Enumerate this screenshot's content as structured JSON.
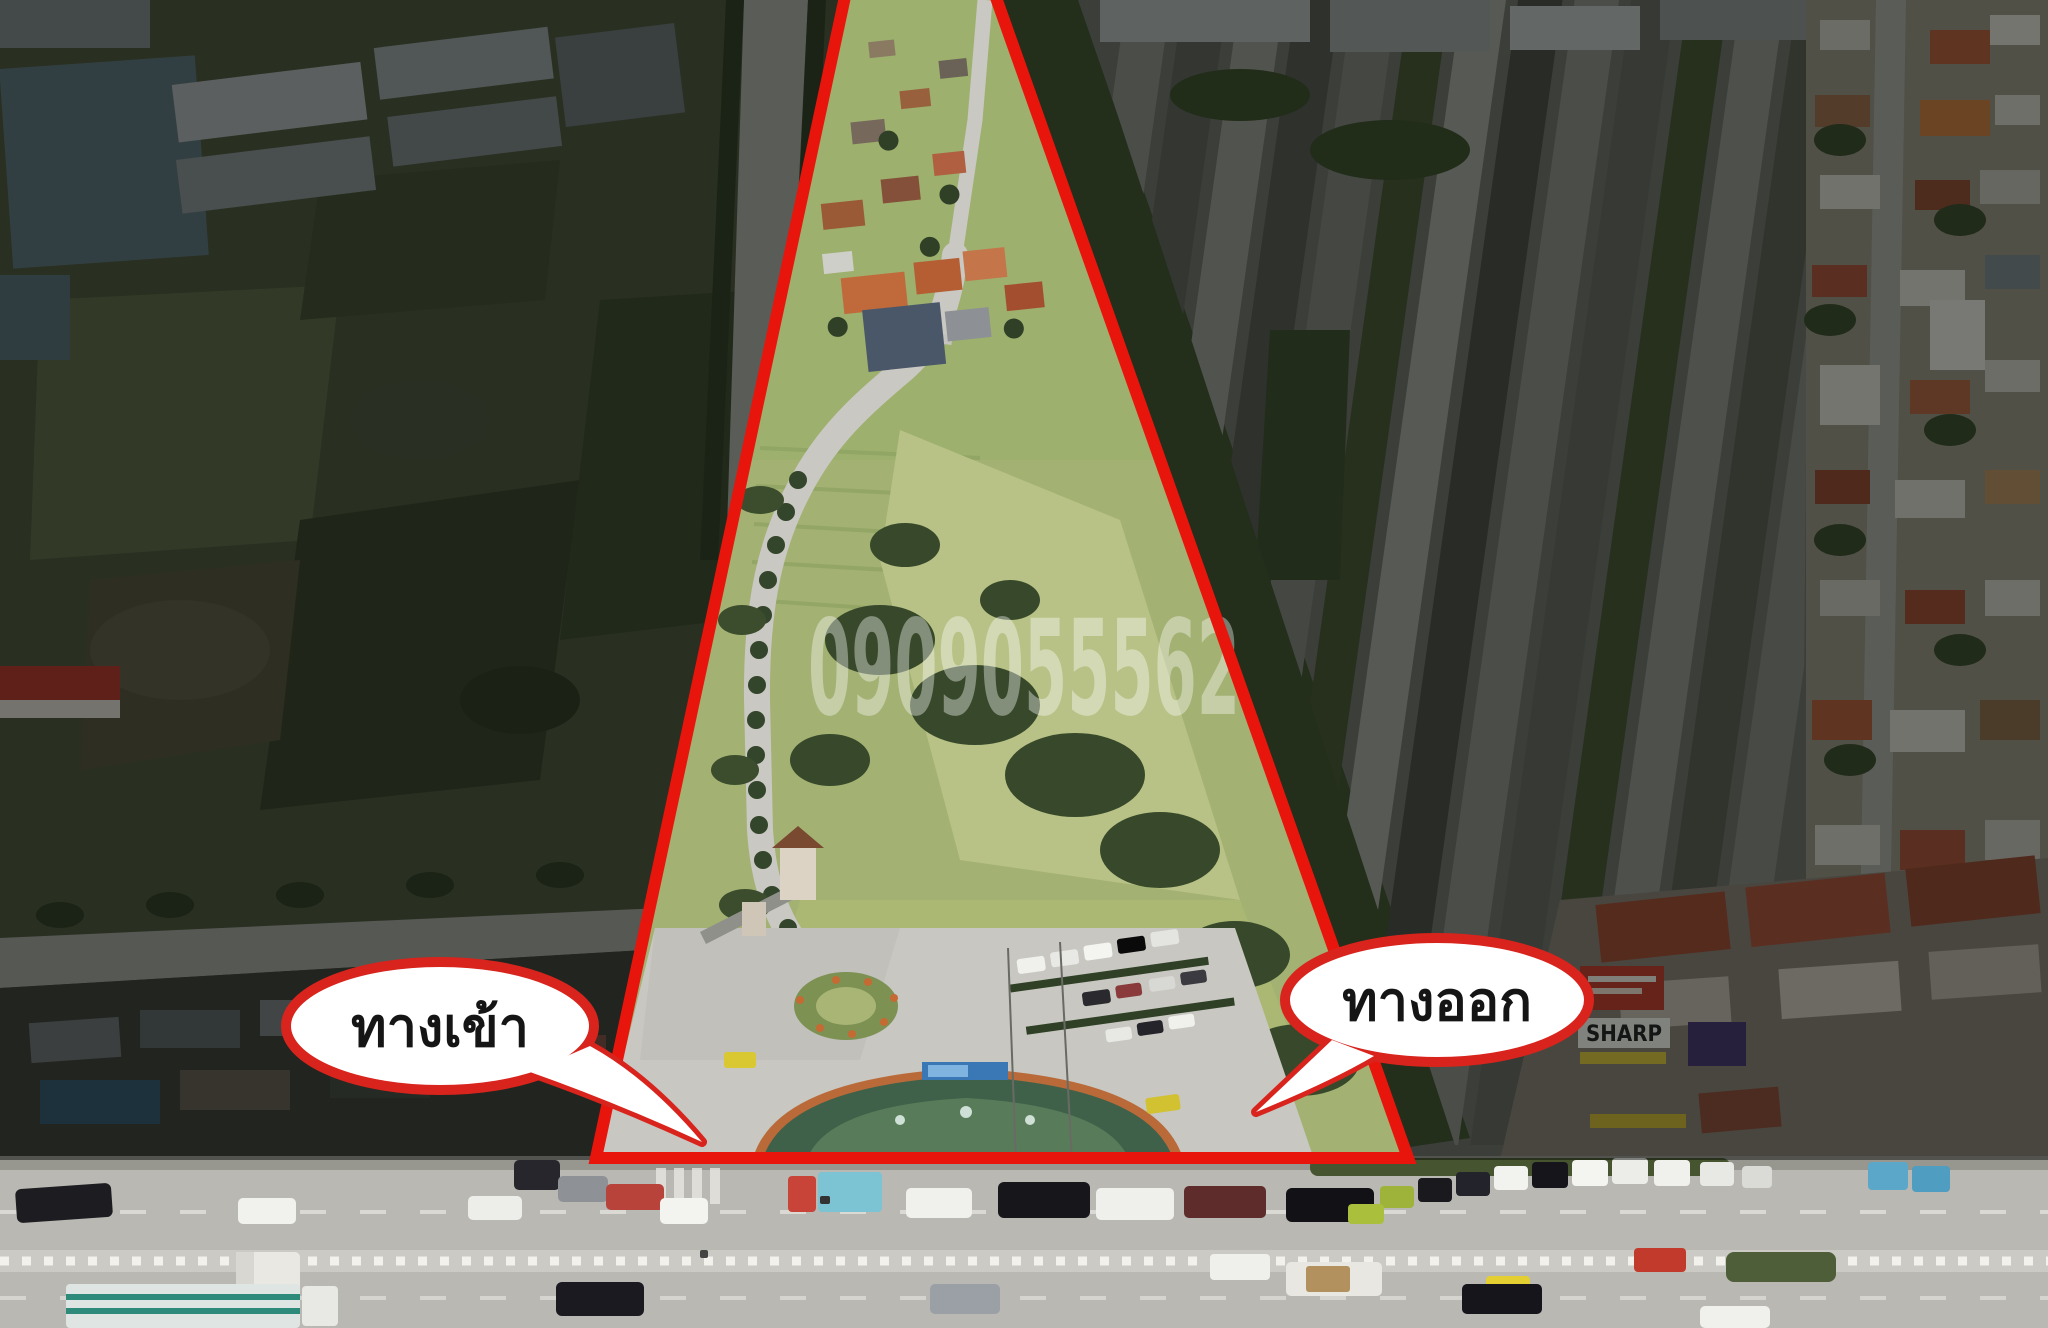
{
  "annotations": {
    "entrance_label": "ทางเข้า",
    "exit_label": "ทางออก",
    "watermark_phone": "0909055562"
  },
  "storefront_signs": {
    "sharp": "SHARP"
  },
  "colors": {
    "boundary_red": "#e8150d",
    "bubble_border_red": "#d8241c",
    "bubble_fill": "#ffffff",
    "label_text": "#151515",
    "watermark": "#ffffff"
  }
}
